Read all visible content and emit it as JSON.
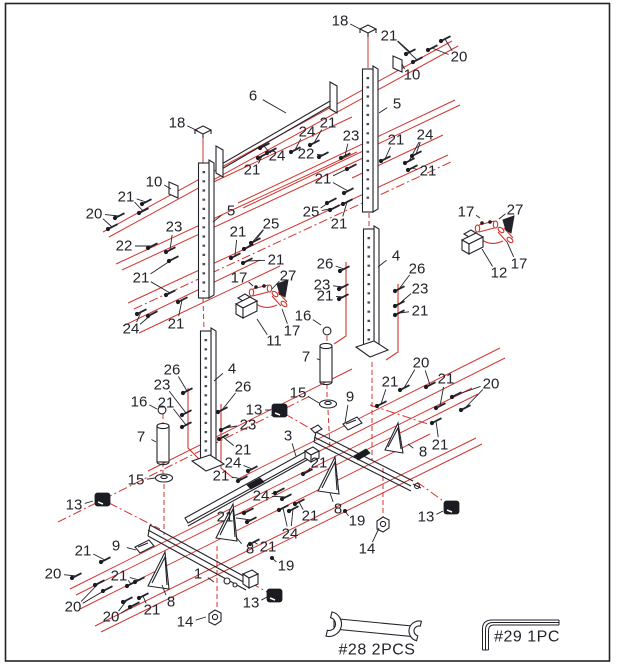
{
  "figure": {
    "type": "exploded-assembly-diagram",
    "colors": {
      "line": "#23232b",
      "accent_red": "#d2342f",
      "background": "#ffffff"
    },
    "tools": [
      {
        "name": "open-end-wrench",
        "label": "#28  2PCS"
      },
      {
        "name": "hex-key",
        "label": "#29  1PC"
      }
    ],
    "part_labels": [
      {
        "t": "18",
        "x": 340,
        "y": 21,
        "l": [
          [
            360,
            29
          ]
        ]
      },
      {
        "t": "21",
        "x": 389,
        "y": 36,
        "l": [
          [
            410,
            52
          ],
          [
            417,
            60
          ]
        ],
        "b": 1
      },
      {
        "t": "20",
        "x": 459,
        "y": 57,
        "l": [
          [
            445,
            39
          ],
          [
            432,
            48
          ]
        ],
        "b": 1
      },
      {
        "t": "10",
        "x": 412,
        "y": 75,
        "l": [
          [
            402,
            64
          ]
        ]
      },
      {
        "t": "6",
        "x": 253,
        "y": 96,
        "l": [
          [
            286,
            113
          ]
        ]
      },
      {
        "t": "5",
        "x": 397,
        "y": 104,
        "l": [
          [
            379,
            113
          ]
        ]
      },
      {
        "t": "18",
        "x": 177,
        "y": 123,
        "l": [
          [
            198,
            131
          ]
        ]
      },
      {
        "t": "21",
        "x": 328,
        "y": 123,
        "l": [
          [
            314,
            143
          ]
        ],
        "b": 1
      },
      {
        "t": "24",
        "x": 307,
        "y": 132,
        "l": [
          [
            295,
            150
          ]
        ],
        "b": 1
      },
      {
        "t": "23",
        "x": 351,
        "y": 136,
        "l": [
          [
            345,
            156
          ]
        ],
        "b": 1
      },
      {
        "t": "22",
        "x": 306,
        "y": 154,
        "l": [
          [
            323,
            155
          ]
        ],
        "b": 1
      },
      {
        "t": "21",
        "x": 396,
        "y": 140,
        "l": [
          [
            385,
            159
          ]
        ],
        "b": 1
      },
      {
        "t": "24",
        "x": 425,
        "y": 135,
        "l": [
          [
            409,
            161
          ],
          [
            416,
            154
          ]
        ],
        "b": 1
      },
      {
        "t": "21",
        "x": 428,
        "y": 171,
        "l": [
          [
            412,
            168
          ]
        ],
        "b": 1
      },
      {
        "t": "24",
        "x": 277,
        "y": 156,
        "l": [
          [
            264,
            146
          ],
          [
            271,
            151
          ]
        ],
        "b": 1
      },
      {
        "t": "21",
        "x": 252,
        "y": 170,
        "l": [
          [
            262,
            156
          ]
        ],
        "b": 1
      },
      {
        "t": "10",
        "x": 154,
        "y": 182,
        "l": [
          [
            171,
            189
          ]
        ]
      },
      {
        "t": "21",
        "x": 126,
        "y": 197,
        "l": [
          [
            146,
            202
          ],
          [
            143,
            211
          ]
        ],
        "b": 1
      },
      {
        "t": "20",
        "x": 94,
        "y": 214,
        "l": [
          [
            119,
            216
          ],
          [
            112,
            227
          ]
        ],
        "b": 1
      },
      {
        "t": "5",
        "x": 231,
        "y": 211,
        "l": [
          [
            213,
            222
          ]
        ]
      },
      {
        "t": "23",
        "x": 174,
        "y": 227,
        "l": [
          [
            170,
            250
          ]
        ],
        "b": 1
      },
      {
        "t": "22",
        "x": 124,
        "y": 246,
        "l": [
          [
            152,
            246
          ]
        ],
        "b": 1
      },
      {
        "t": "21",
        "x": 238,
        "y": 232,
        "l": [
          [
            235,
            256
          ]
        ],
        "b": 1
      },
      {
        "t": "25",
        "x": 271,
        "y": 224,
        "l": [
          [
            248,
            247
          ],
          [
            255,
            241
          ]
        ],
        "b": 1
      },
      {
        "t": "21",
        "x": 141,
        "y": 278,
        "l": [
          [
            173,
            259
          ],
          [
            170,
            293
          ]
        ],
        "b": 1
      },
      {
        "t": "21",
        "x": 276,
        "y": 260,
        "l": [
          [
            247,
            261
          ]
        ],
        "b": 1
      },
      {
        "t": "25",
        "x": 311,
        "y": 212,
        "l": [
          [
            331,
            201
          ],
          [
            334,
            208
          ]
        ],
        "b": 1
      },
      {
        "t": "21",
        "x": 339,
        "y": 224,
        "l": [
          [
            347,
            202
          ]
        ],
        "b": 1
      },
      {
        "t": "21",
        "x": 323,
        "y": 179,
        "l": [
          [
            351,
            167
          ],
          [
            348,
            191
          ]
        ],
        "b": 1
      },
      {
        "t": "17",
        "x": 466,
        "y": 212,
        "l": [
          [
            480,
            218
          ]
        ]
      },
      {
        "t": "27",
        "x": 515,
        "y": 210,
        "l": [
          [
            499,
            219
          ],
          [
            506,
            227
          ]
        ]
      },
      {
        "t": "12",
        "x": 499,
        "y": 273,
        "l": [
          [
            482,
            249
          ]
        ]
      },
      {
        "t": "17",
        "x": 519,
        "y": 264,
        "l": [
          [
            507,
            242
          ]
        ]
      },
      {
        "t": "17",
        "x": 239,
        "y": 278,
        "l": [
          [
            253,
            286
          ]
        ]
      },
      {
        "t": "27",
        "x": 288,
        "y": 276,
        "l": [
          [
            272,
            289
          ],
          [
            279,
            295
          ]
        ]
      },
      {
        "t": "11",
        "x": 274,
        "y": 341,
        "l": [
          [
            257,
            319
          ]
        ]
      },
      {
        "t": "17",
        "x": 292,
        "y": 331,
        "l": [
          [
            282,
            309
          ]
        ]
      },
      {
        "t": "16",
        "x": 303,
        "y": 316,
        "l": [
          [
            321,
            325
          ]
        ]
      },
      {
        "t": "7",
        "x": 306,
        "y": 357,
        "l": [
          [
            320,
            360
          ]
        ]
      },
      {
        "t": "26",
        "x": 325,
        "y": 264,
        "l": [
          [
            344,
            269
          ]
        ],
        "b": 1
      },
      {
        "t": "23",
        "x": 322,
        "y": 285,
        "l": [
          [
            343,
            287
          ]
        ],
        "b": 1
      },
      {
        "t": "21",
        "x": 325,
        "y": 296,
        "l": [
          [
            343,
            297
          ]
        ],
        "b": 1
      },
      {
        "t": "26",
        "x": 417,
        "y": 269,
        "l": [
          [
            399,
            289
          ]
        ],
        "b": 1
      },
      {
        "t": "23",
        "x": 420,
        "y": 289,
        "l": [
          [
            399,
            304
          ]
        ],
        "b": 1
      },
      {
        "t": "21",
        "x": 420,
        "y": 311,
        "l": [
          [
            399,
            313
          ]
        ],
        "b": 1
      },
      {
        "t": "4",
        "x": 396,
        "y": 256,
        "l": [
          [
            378,
            267
          ]
        ]
      },
      {
        "t": "24",
        "x": 131,
        "y": 329,
        "l": [
          [
            141,
            312
          ],
          [
            152,
            314
          ]
        ],
        "b": 1
      },
      {
        "t": "21",
        "x": 176,
        "y": 324,
        "l": [
          [
            182,
            300
          ]
        ],
        "b": 1
      },
      {
        "t": "26",
        "x": 172,
        "y": 370,
        "l": [
          [
            187,
            391
          ]
        ],
        "b": 1
      },
      {
        "t": "23",
        "x": 162,
        "y": 385,
        "l": [
          [
            186,
            413
          ]
        ],
        "b": 1
      },
      {
        "t": "16",
        "x": 139,
        "y": 402,
        "l": [
          [
            157,
            409
          ]
        ]
      },
      {
        "t": "21",
        "x": 166,
        "y": 403,
        "l": [
          [
            186,
            425
          ]
        ],
        "b": 1
      },
      {
        "t": "4",
        "x": 232,
        "y": 369,
        "l": [
          [
            214,
            381
          ]
        ]
      },
      {
        "t": "26",
        "x": 243,
        "y": 387,
        "l": [
          [
            222,
            410
          ]
        ],
        "b": 1
      },
      {
        "t": "23",
        "x": 248,
        "y": 425,
        "l": [
          [
            225,
            428
          ]
        ],
        "b": 1
      },
      {
        "t": "21",
        "x": 243,
        "y": 450,
        "l": [
          [
            223,
            437
          ]
        ],
        "b": 1
      },
      {
        "t": "7",
        "x": 141,
        "y": 437,
        "l": [
          [
            156,
            442
          ]
        ]
      },
      {
        "t": "15",
        "x": 136,
        "y": 480,
        "l": [
          [
            155,
            478
          ]
        ]
      },
      {
        "t": "13",
        "x": 74,
        "y": 505,
        "l": [
          [
            93,
            501
          ]
        ]
      },
      {
        "t": "15",
        "x": 298,
        "y": 393,
        "l": [
          [
            319,
            403
          ]
        ]
      },
      {
        "t": "13",
        "x": 254,
        "y": 410,
        "l": [
          [
            271,
            410
          ]
        ]
      },
      {
        "t": "9",
        "x": 350,
        "y": 397,
        "l": [
          [
            345,
            423
          ]
        ]
      },
      {
        "t": "3",
        "x": 288,
        "y": 436,
        "l": [
          [
            296,
            456
          ]
        ]
      },
      {
        "t": "24",
        "x": 233,
        "y": 463,
        "l": [
          [
            252,
            469
          ]
        ],
        "b": 1
      },
      {
        "t": "21",
        "x": 221,
        "y": 476,
        "l": [
          [
            242,
            479
          ]
        ],
        "b": 1
      },
      {
        "t": "24",
        "x": 261,
        "y": 496,
        "l": [
          [
            279,
            491
          ],
          [
            286,
            497
          ]
        ],
        "b": 1
      },
      {
        "t": "21",
        "x": 319,
        "y": 463,
        "l": [
          [
            307,
            472
          ]
        ],
        "b": 1
      },
      {
        "t": "21",
        "x": 310,
        "y": 516,
        "l": [
          [
            299,
            502
          ]
        ],
        "b": 1
      },
      {
        "t": "8",
        "x": 338,
        "y": 509,
        "l": [
          [
            330,
            493
          ]
        ]
      },
      {
        "t": "21",
        "x": 225,
        "y": 517,
        "l": [
          [
            248,
            511
          ],
          [
            251,
            520
          ]
        ],
        "b": 1
      },
      {
        "t": "9",
        "x": 116,
        "y": 546,
        "l": [
          [
            136,
            550
          ]
        ]
      },
      {
        "t": "21",
        "x": 83,
        "y": 551,
        "l": [
          [
            105,
            560
          ]
        ],
        "b": 1
      },
      {
        "t": "20",
        "x": 53,
        "y": 574,
        "l": [
          [
            76,
            576
          ]
        ],
        "b": 1
      },
      {
        "t": "21",
        "x": 119,
        "y": 576,
        "l": [
          [
            131,
            584
          ],
          [
            139,
            580
          ]
        ],
        "b": 1
      },
      {
        "t": "20",
        "x": 73,
        "y": 607,
        "l": [
          [
            99,
            583
          ],
          [
            107,
            589
          ]
        ],
        "b": 1
      },
      {
        "t": "20",
        "x": 111,
        "y": 617,
        "l": [
          [
            127,
            600
          ],
          [
            134,
            605
          ]
        ],
        "b": 1
      },
      {
        "t": "21",
        "x": 152,
        "y": 610,
        "l": [
          [
            143,
            596
          ]
        ],
        "b": 1
      },
      {
        "t": "8",
        "x": 171,
        "y": 602,
        "l": [
          [
            162,
            585
          ]
        ]
      },
      {
        "t": "1",
        "x": 198,
        "y": 574,
        "l": [
          [
            214,
            582
          ]
        ]
      },
      {
        "t": "8",
        "x": 250,
        "y": 549,
        "l": [
          [
            236,
            537
          ]
        ]
      },
      {
        "t": "21",
        "x": 268,
        "y": 547,
        "l": [
          [
            254,
            542
          ]
        ],
        "b": 1
      },
      {
        "t": "19",
        "x": 286,
        "y": 566,
        "l": [
          [
            272,
            558
          ]
        ],
        "d": 1
      },
      {
        "t": "13",
        "x": 251,
        "y": 603,
        "l": [
          [
            267,
            597
          ]
        ]
      },
      {
        "t": "14",
        "x": 185,
        "y": 622,
        "l": [
          [
            206,
            617
          ]
        ]
      },
      {
        "t": "19",
        "x": 357,
        "y": 521,
        "l": [
          [
            345,
            511
          ]
        ],
        "d": 1
      },
      {
        "t": "14",
        "x": 367,
        "y": 549,
        "l": [
          [
            379,
            528
          ]
        ]
      },
      {
        "t": "13",
        "x": 426,
        "y": 517,
        "l": [
          [
            443,
            511
          ]
        ]
      },
      {
        "t": "20",
        "x": 421,
        "y": 363,
        "l": [
          [
            404,
            388
          ],
          [
            430,
            385
          ]
        ],
        "b": 1
      },
      {
        "t": "21",
        "x": 390,
        "y": 382,
        "l": [
          [
            381,
            404
          ]
        ],
        "b": 1
      },
      {
        "t": "21",
        "x": 446,
        "y": 379,
        "l": [
          [
            440,
            406
          ]
        ],
        "b": 1
      },
      {
        "t": "20",
        "x": 491,
        "y": 384,
        "l": [
          [
            456,
            395
          ],
          [
            465,
            408
          ]
        ],
        "b": 1
      },
      {
        "t": "21",
        "x": 440,
        "y": 445,
        "l": [
          [
            436,
            421
          ]
        ],
        "b": 1
      },
      {
        "t": "8",
        "x": 423,
        "y": 452,
        "l": [
          [
            408,
            444
          ]
        ]
      },
      {
        "t": "24",
        "x": 290,
        "y": 534,
        "l": [
          [
            283,
            508
          ],
          [
            293,
            509
          ]
        ],
        "b": 1
      }
    ]
  }
}
